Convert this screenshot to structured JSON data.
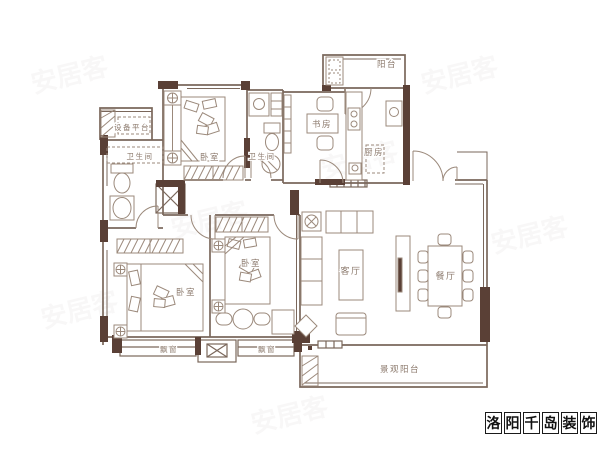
{
  "colors": {
    "wall_fill": "#5a4036",
    "wall_line": "#7a675b",
    "furniture_line": "#9b897b",
    "label_text": "#8c7a6d",
    "brand_text": "#111111"
  },
  "rooms": {
    "balcony": "阳台",
    "kitchen": "厨房",
    "study": "书房",
    "bathroom_top": "卫生间",
    "bathroom_left": "卫生间",
    "bedroom_top": "卧室",
    "bedroom_left": "卧室",
    "bedroom_middle": "卧室",
    "living_room": "客厅",
    "dining_room": "餐厅",
    "bay_window_left": "飘窗",
    "bay_window_right": "飘窗",
    "view_balcony": "景观阳台",
    "equipment_platform": "设备平台"
  },
  "branding": {
    "name": "洛阳千岛装饰",
    "chars": [
      "洛",
      "阳",
      "千",
      "岛",
      "装",
      "饰"
    ]
  },
  "background_watermark": "安居客"
}
